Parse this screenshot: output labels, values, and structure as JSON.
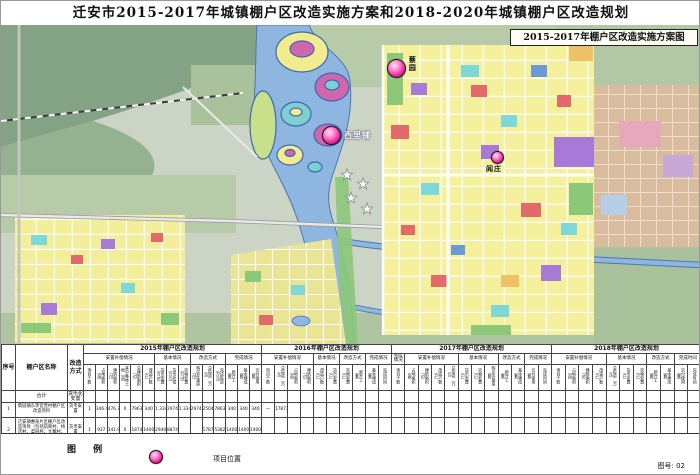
{
  "title": "迁安市2015-2017年城镇棚户区改造实施方案和2018-2020年城镇棚户区改造规划",
  "map": {
    "inset_title": "2015-2017年棚户区改造实施方案图",
    "markers": [
      {
        "label": "蔡园"
      },
      {
        "label": "西里铺"
      },
      {
        "label": "阎庄"
      }
    ]
  },
  "table": {
    "fixed_cols": [
      {
        "key": "seq",
        "label": "序号",
        "width": 14
      },
      {
        "key": "name",
        "label": "棚户区名称",
        "width": 52
      },
      {
        "key": "mode",
        "label": "改造方式",
        "width": 16
      }
    ],
    "year_groups": [
      {
        "label": "2015年棚户区改造规划",
        "width": 178,
        "subgroups": [
          {
            "label": "安置补偿情况",
            "span": 6
          },
          {
            "label": "基本情况",
            "span": 3
          },
          {
            "label": "改造方式",
            "span": 3
          },
          {
            "label": "完成情况",
            "span": 3
          }
        ],
        "leaves": [
          "项目个数",
          "占地面积（亩）",
          "建筑面积（㎡）",
          "其中集体土地（亩）",
          "总建筑面积（㎡）",
          "改造户数（户）",
          "货币安置（万㎡）",
          "货币补偿（万元）",
          "实物安置（万㎡）",
          "购买存量房（㎡）",
          "总投资（万元）",
          "完成投资（万元）",
          "新开工（套）",
          "基本建成（套）",
          "交付使用（套）"
        ]
      },
      {
        "label": "2016年棚户区改造规划",
        "width": 130,
        "subgroups": [
          {
            "label": "安置补偿情况",
            "span": 4
          },
          {
            "label": "基本情况",
            "span": 2
          },
          {
            "label": "改造方式",
            "span": 2
          },
          {
            "label": "完成情况",
            "span": 2
          }
        ],
        "leaves": [
          "项目个数",
          "总投资（万元）",
          "占地面积（亩）",
          "建筑面积（㎡）",
          "改造户数（户）",
          "货币安置（户）",
          "实物安置（户）",
          "新开工（套）",
          "基本建成（套）",
          "完成时间"
        ]
      },
      {
        "label": "2017年棚户区改造规划",
        "width": 160,
        "subgroups": [
          {
            "label": "完成情况",
            "span": 1
          },
          {
            "label": "安置补偿情况",
            "span": 4
          },
          {
            "label": "基本情况",
            "span": 3
          },
          {
            "label": "改造方式",
            "span": 2
          },
          {
            "label": "完成情况",
            "span": 2
          }
        ],
        "leaves": [
          "项目个数",
          "占地面积（亩）",
          "建筑面积（㎡）",
          "改造户数（户）",
          "总投资（万元）",
          "货币安置（户）",
          "实物安置（户）",
          "购买存量房（套）",
          "新开工（套）",
          "基本建成（套）",
          "交付使用（套）",
          "完成时间"
        ]
      },
      {
        "label": "2018年棚户区改造规划",
        "width": 150,
        "subgroups": [
          {
            "label": "安置补偿情况",
            "span": 4
          },
          {
            "label": "基本情况",
            "span": 3
          },
          {
            "label": "改造方式",
            "span": 2
          },
          {
            "label": "完成时间",
            "span": 2
          }
        ],
        "leaves": [
          "项目个数",
          "占地面积（亩）",
          "建筑面积（㎡）",
          "改造户数（户）",
          "总投资（万元）",
          "货币安置（户）",
          "实物安置（户）",
          "新开工（套）",
          "基本建成（套）",
          "交付使用（套）",
          "完成时间"
        ]
      }
    ],
    "rows": [
      {
        "cls": "body-sum",
        "seq": "",
        "name": "合计",
        "mode": "货币化安置",
        "values": [
          "",
          "",
          "",
          "",
          "",
          "",
          "",
          "",
          "",
          "",
          "",
          "",
          "",
          "",
          "",
          "",
          "",
          "",
          "",
          "",
          "",
          "",
          "",
          "",
          "",
          "",
          "",
          "",
          "",
          "",
          "",
          "",
          "",
          "",
          "",
          "",
          "",
          "",
          "",
          "",
          "",
          "",
          "",
          "",
          "",
          "",
          "",
          ""
        ]
      },
      {
        "cls": "body-r1",
        "seq": "1",
        "name": "蔡园镇东李官营村棚户区改造项目",
        "mode": "货币安置",
        "values": [
          "1",
          "346.4",
          "476.7",
          "0",
          "79633",
          "340",
          "1.334",
          "29745",
          "1.334",
          "29745",
          "25049",
          "78633",
          "340",
          "340",
          "340",
          "—",
          "17873",
          "",
          "",
          "",
          "",
          "",
          "",
          "",
          "",
          "",
          "",
          "",
          "",
          "",
          "",
          "",
          "",
          "",
          "",
          "",
          "",
          "",
          "",
          "",
          "",
          "",
          "",
          "",
          "",
          "",
          "",
          ""
        ]
      },
      {
        "cls": "body-r2",
        "seq": "2",
        "name": "迁安镇惠泉片区棚户区改造项目（包括前窝村、杨店村、菜园村、大寨村、人民楼等）",
        "mode": "货币安置",
        "values": [
          "1",
          "937",
          "341.9",
          "0",
          "18745",
          "1400",
          "2940",
          "88745",
          "",
          "",
          "17873",
          "5382.07",
          "1400",
          "1400",
          "1400",
          "",
          "",
          "",
          "",
          "",
          "",
          "",
          "",
          "",
          "",
          "",
          "",
          "",
          "",
          "",
          "",
          "",
          "",
          "",
          "",
          "",
          "",
          "",
          "",
          "",
          "",
          "",
          "",
          "",
          "",
          "",
          "",
          ""
        ]
      }
    ]
  },
  "legend": {
    "title": "图  例",
    "marker_label": "项目位置",
    "sheet_no": "图号: 02"
  }
}
